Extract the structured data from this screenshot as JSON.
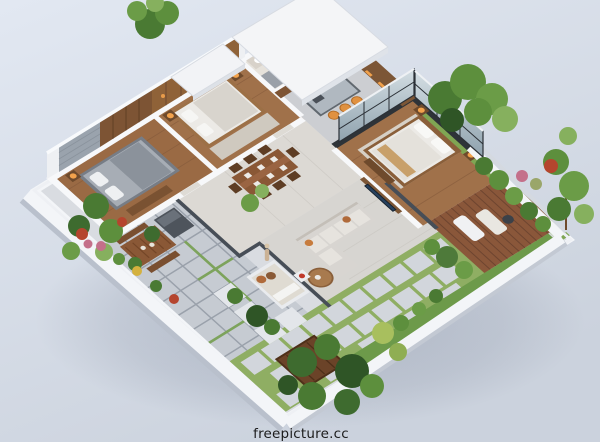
{
  "meta": {
    "type": "3d-isometric-floor-plan-render",
    "subject": "Photorealistic isometric 3D floor plan of a modern single-storey home with furnished bedrooms, kitchen, dining area, living room, patio, sun deck and landscaped gardens on a light blue-gray backdrop"
  },
  "background": {
    "top": "#e2e8f2",
    "bottom": "#cbd2dd"
  },
  "watermark": {
    "text": "freepicture.cc",
    "color": "#1b1b1b"
  },
  "palette": {
    "wall_cap": "#f3f5f8",
    "wall_face": "#eef0f3",
    "wall_shade": "#bcc3cf",
    "tile_floor": "#dcd9d4",
    "living_tile": "#d7d5d1",
    "wood_floor": "#a0714a",
    "wood_dark": "#7d5434",
    "wardrobe_wood": "#8f6238",
    "stone_wall": "#9aa3ad",
    "paver_gray": "#c6cbd2",
    "slab_light": "#d2d6dc",
    "grass_green": "#8fae63",
    "lawn_green": "#6d9a4a",
    "deck_wood": "#8a573a",
    "glass_frame": "#2e3338",
    "sofa_gray": "#d8d5d1",
    "bed_white": "#eceae6",
    "furniture_wood": "#6e4a2c",
    "tv_screen": "#27415f",
    "stool_orange": "#e09140",
    "lamp_orange": "#f2a24c",
    "foliage_darkest": "#2f5526",
    "foliage_dark": "#4a7a33",
    "foliage_mid": "#5d8f3d",
    "foliage_light": "#86b05e",
    "flower_red": "#b5452e",
    "flower_pink": "#c4708a"
  },
  "scene_elements": [
    "bedroom-left",
    "bedroom-top",
    "bathroom",
    "kitchen",
    "dining-area",
    "master-bedroom",
    "living-room",
    "patio",
    "outdoor-dining-table",
    "grill-unit",
    "daybed-lounger",
    "sun-deck",
    "garden-gate",
    "stepping-stone-path",
    "lawn-strips",
    "perimeter-wall",
    "roof-slabs",
    "window-walls",
    "trees-and-shrubs",
    "watermark"
  ]
}
